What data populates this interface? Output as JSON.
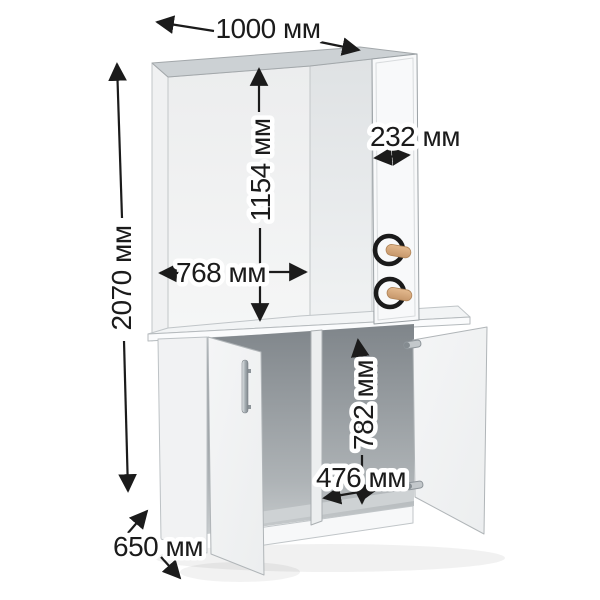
{
  "diagram": {
    "unit": "мм",
    "dimensions": {
      "overall_width": "1000 мм",
      "overall_height": "2070 мм",
      "niche_height": "1154 мм",
      "niche_width": "768 мм",
      "hook_panel_width": "232 мм",
      "lower_inner_height": "782 мм",
      "lower_inner_width": "476 мм",
      "depth": "650 мм"
    },
    "parts": {
      "hook_count": 2,
      "door_count": 2
    },
    "colors": {
      "background": "#ffffff",
      "dimension_line": "#1b1b1b",
      "hook_ring": "#1a1a1a",
      "hook_peg": "#d4a478",
      "panel_face": "#f6f7f8",
      "interior_shadow": "#878d92"
    }
  }
}
